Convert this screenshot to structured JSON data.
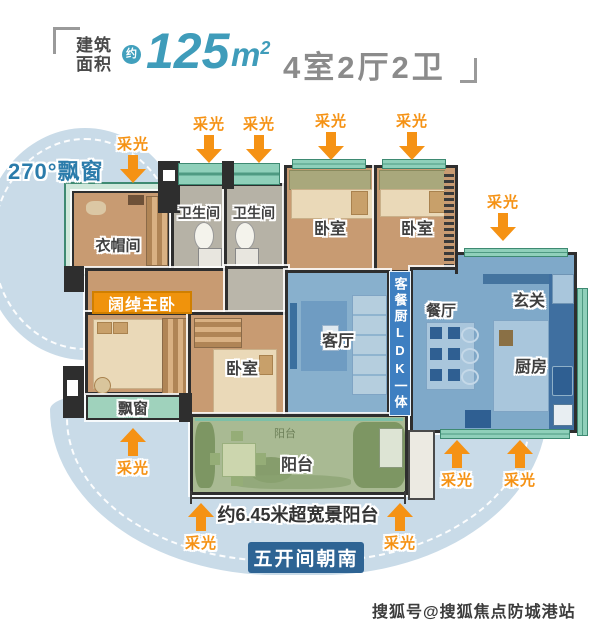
{
  "header": {
    "area_label_line1": "建筑",
    "area_label_line2": "面积",
    "approx_badge": "约",
    "area_value": "125",
    "area_unit_base": "m",
    "area_unit_exp": "2",
    "layout_text": "4室2厅2卫"
  },
  "plan": {
    "rooms": {
      "cloakroom": "衣帽间",
      "bath1": "卫生间",
      "bath2": "卫生间",
      "bed_tr1": "卧室",
      "bed_tr2": "卧室",
      "bed_mid": "卧室",
      "bay_window": "飘窗",
      "living": "客厅",
      "dining": "餐厅",
      "foyer": "玄关",
      "kitchen": "厨房",
      "balcony": "阳台",
      "balcony_small": "阳台"
    },
    "badges": {
      "master": "阔绰主卧",
      "ldk": "客餐厨LDK一体",
      "south_facing": "五开间朝南"
    },
    "callouts": {
      "bay270": "270°飘窗",
      "daylight": "采光",
      "balcony_width": "约6.45米超宽景阳台"
    }
  },
  "watermark": {
    "text": "搜狐号@搜狐焦点防城港站"
  },
  "palette": {
    "accent_orange": "#f59214",
    "badge_orange": "#f0930c",
    "header_teal": "#3f9cba",
    "blue_zone": "#7fa9c9",
    "tan_zone": "#c89b72",
    "balcony_green": "#a9ba93",
    "blob_blue": "#c9dbe8",
    "badge_blue": "#2e6494",
    "ldk_banner_blue": "#3e7fc1"
  }
}
